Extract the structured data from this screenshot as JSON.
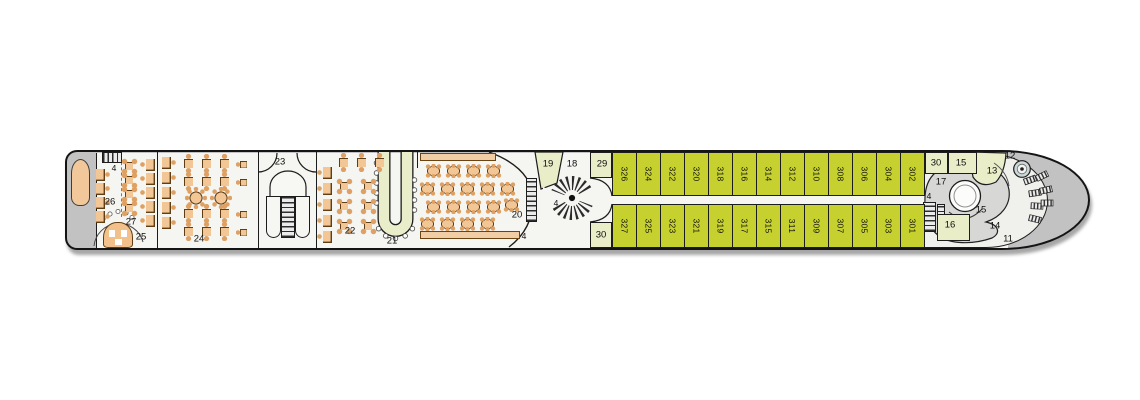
{
  "deck_plan": {
    "cabins": {
      "top_row": [
        "326",
        "324",
        "322",
        "320",
        "318",
        "316",
        "314",
        "312",
        "310",
        "308",
        "306",
        "304",
        "302"
      ],
      "bottom_row": [
        "327",
        "325",
        "323",
        "321",
        "319",
        "317",
        "315",
        "311",
        "309",
        "307",
        "305",
        "303",
        "301"
      ]
    },
    "labels": {
      "stairs_stern": "4",
      "seating_26": "26",
      "tables_27": "27",
      "booth_25": "25",
      "lounge_24": "24",
      "lobby_23": "23",
      "tables_22": "22",
      "bar_21": "21",
      "restaurant_20": "20",
      "stairs_restaurant": "4",
      "room_19": "19",
      "room_18": "18",
      "stairs_landing": "4",
      "room_29": "29",
      "room_30_mid": "30",
      "room_30_bow": "30",
      "room_15_bow": "15",
      "room_13": "13",
      "capstan_12": "12",
      "room_17": "17",
      "stairs_bow": "4",
      "pool_15": "15",
      "room_16": "16",
      "room_14": "14",
      "walkway_11": "11"
    },
    "colors": {
      "cabin_fill": "#c6d12f",
      "public_room_fill": "#e9edc8",
      "furniture_fill": "#f3c795",
      "hull_gray": "#c2c2c2",
      "wheelhouse_gray": "#d7d7d5"
    }
  }
}
